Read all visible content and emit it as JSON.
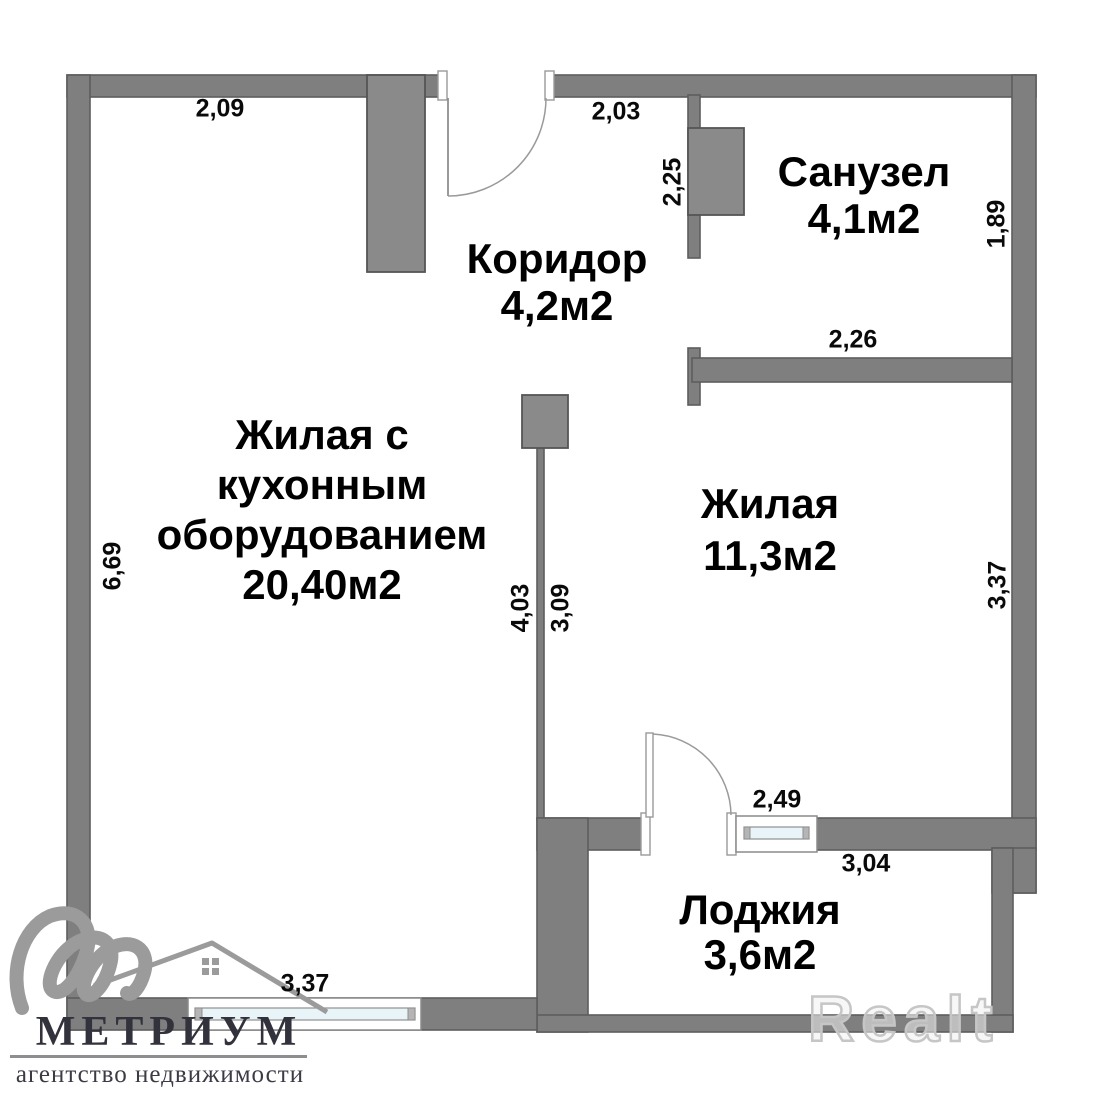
{
  "plan": {
    "rooms": {
      "bathroom": {
        "name": "Санузел",
        "area": "4,1м2"
      },
      "corridor": {
        "name": "Коридор",
        "area": "4,2м2"
      },
      "kitchen_living": {
        "name_line1": "Жилая с",
        "name_line2": "кухонным",
        "name_line3": "оборудованием",
        "area": "20,40м2"
      },
      "living": {
        "name": "Жилая",
        "area": "11,3м2"
      },
      "loggia": {
        "name": "Лоджия",
        "area": "3,6м2"
      }
    },
    "dimensions": {
      "kitchen_top_width": "2,09",
      "corridor_top_width": "2,03",
      "corridor_right_height": "2,25",
      "bathroom_right_height": "1,89",
      "bathroom_bottom_width": "2,26",
      "kitchen_left_height": "6,69",
      "kitchen_partition_height": "4,03",
      "living_partition_height": "3,09",
      "living_right_height": "3,37",
      "loggia_door_width": "2,49",
      "loggia_top_width": "3,04",
      "kitchen_bottom_width": "3,37"
    }
  },
  "branding": {
    "agency_name": "МЕТРИУМ",
    "agency_tagline": "агентство недвижимости",
    "watermark": "Realt"
  },
  "colors": {
    "wall": "#7f7f7f",
    "wall_stroke": "#5d5d5d",
    "block": "#8a8a8a",
    "glass": "#e9f4f8",
    "logo_gray": "#9b9b9b",
    "logo_text": "#32323c",
    "dimension_text": "#0a0a0a"
  }
}
